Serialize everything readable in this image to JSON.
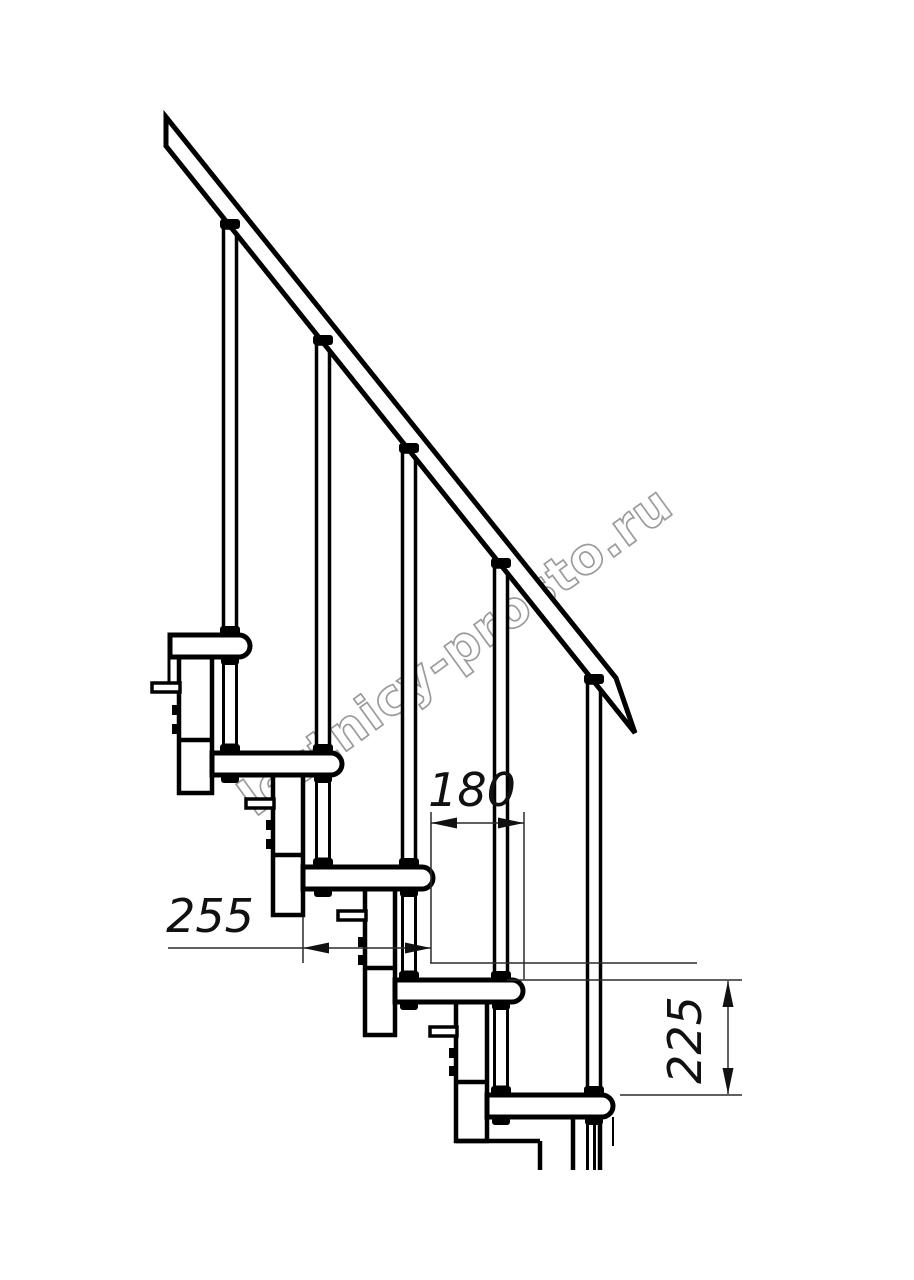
{
  "drawing": {
    "title": "staircase-side-view",
    "watermark": "lestnicy-prosto.ru",
    "dimensions": {
      "run": {
        "value": "180",
        "meaning": "step run between tread ends"
      },
      "tread_depth": {
        "value": "255",
        "meaning": "tread depth"
      },
      "riser": {
        "value": "225",
        "meaning": "riser height between treads"
      }
    },
    "colors": {
      "line": "#000000",
      "thin_line": "#2b2b2b",
      "watermark": "#9b9b9b",
      "background": "#ffffff"
    }
  }
}
